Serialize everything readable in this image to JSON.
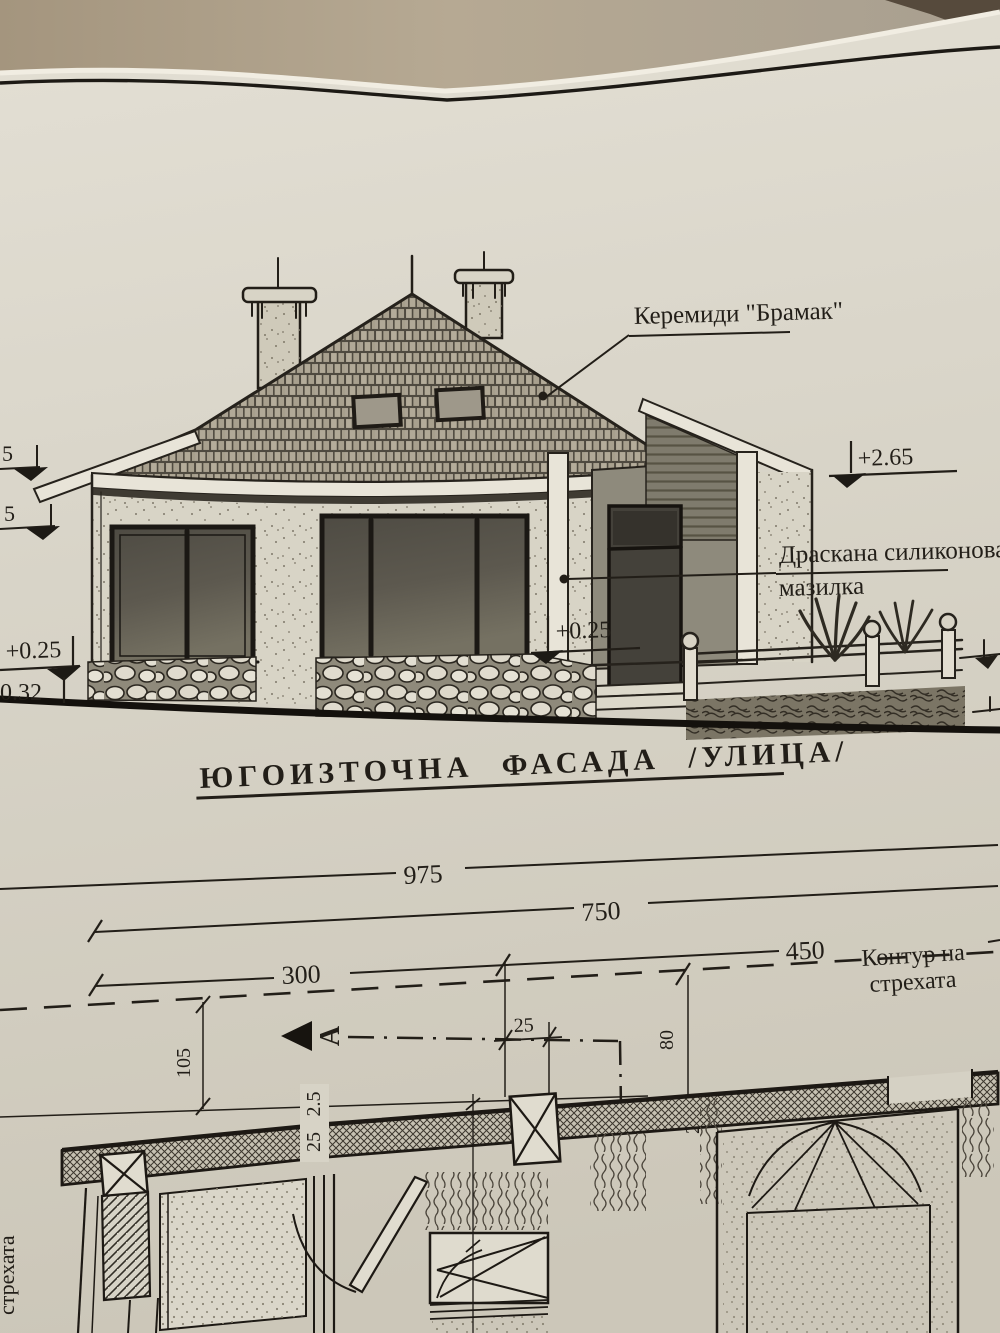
{
  "photo": {
    "background_color": "#b0a18b",
    "page_color": "#d9d5c9",
    "ink_color": "#221e18"
  },
  "elevation": {
    "title": "ЮГОИЗТОЧНА ФАСАДА /УЛИЦА/",
    "annotations": {
      "roof_tiles": "Керемиди \"Брамак\"",
      "plaster_line1": "Драскана силиконова",
      "plaster_line2": "мазилка"
    },
    "levels": {
      "eaves": "+2.65",
      "left_partial_upper": "5",
      "left_partial_lower": "5",
      "terrace": "+0.25",
      "ground": "0.32",
      "entrance": "+0.25"
    }
  },
  "plan": {
    "dims": {
      "overall": "975",
      "d750": "750",
      "d300": "300",
      "d450": "450",
      "d105": "105",
      "d25_eave": "25",
      "d80": "80",
      "d25_wall": "25",
      "layer_a": "2.5",
      "layer_b": "25"
    },
    "labels": {
      "eaves_contour_1": "Контур на",
      "eaves_contour_2": "стрехата",
      "section_letter": "A",
      "edge_vertical": "стрехата"
    }
  }
}
